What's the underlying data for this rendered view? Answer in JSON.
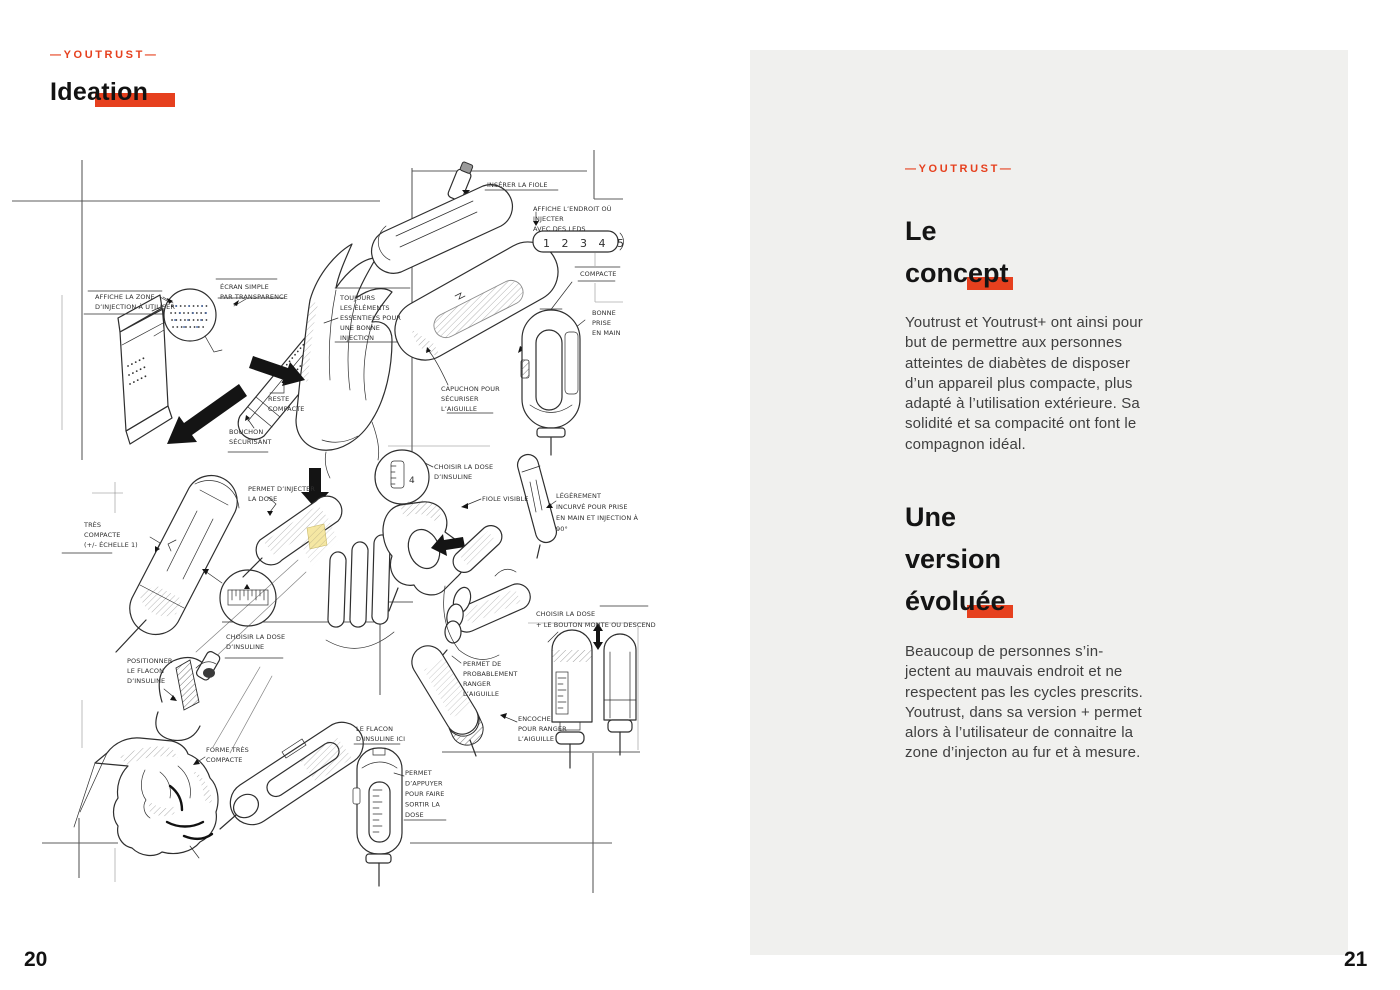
{
  "colors": {
    "accent": "#e6401e",
    "panel": "#f0f0ee",
    "sketch_blue": "#3b5fa0",
    "sketch_yellow": "#f5e7a3"
  },
  "left_page": {
    "brand": "—YOUTRUST—",
    "title": "Ideation",
    "page_number": "20",
    "sketch": {
      "led_scale": "1 2 3 4 5",
      "dose_value": "4",
      "annotations": {
        "zone": [
          "AFFICHE LA ZONE",
          "D’INJECTION À UTILISER"
        ],
        "ecran": [
          "ÉCRAN SIMPLE",
          "PAR TRANSPARENCE"
        ],
        "toujours": [
          "TOUJOURS",
          "LES ÉLÉMENTS",
          "ESSENTIELS POUR",
          "UNE BONNE",
          "INJECTION"
        ],
        "reste": [
          "RESTE",
          "COMPACTE"
        ],
        "bouchon": [
          "BOUCHON",
          "SÉCURISANT"
        ],
        "inserer": [
          "INSÉRER LA FIOLE"
        ],
        "endroit": [
          "AFFICHE L’ENDROIT OÙ",
          "INJECTER",
          "AVEC DES LEDS"
        ],
        "compacte": [
          "COMPACTE"
        ],
        "prise": [
          "BONNE",
          "PRISE",
          "EN MAIN"
        ],
        "capuchon": [
          "CAPUCHON POUR",
          "SÉCURISER",
          "L’AIGUILLE"
        ],
        "tres_compacte": [
          "TRÈS",
          "COMPACTE",
          "(+/- ÉCHELLE 1)"
        ],
        "injecter_dose": [
          "PERMET D’INJECTER",
          "LA DOSE"
        ],
        "choisir1": [
          "CHOISIR LA DOSE",
          "D’INSULINE"
        ],
        "positionner": [
          "POSITIONNER",
          "LE FLACON",
          "D’INSULINE"
        ],
        "choisir2": [
          "CHOISIR LA DOSE",
          "D’INSULINE"
        ],
        "fiole_visible": [
          "FIOLE VISIBLE"
        ],
        "incurve": [
          "LÉGÈREMENT",
          "INCURVÉ POUR PRISE",
          "EN MAIN ET INJECTION À",
          "90°"
        ],
        "choisir3": [
          "CHOISIR LA DOSE",
          "+ LE BOUTON  MONTE OU DESCEND"
        ],
        "ranger": [
          "PERMET DE",
          "PROBABLEMENT",
          "RANGER",
          "L’AIGUILLE"
        ],
        "encoche": [
          "ENCOCHE",
          "POUR RANGER",
          "L’AIGUILLE"
        ],
        "forme": [
          "FORME TRÈS",
          "COMPACTE"
        ],
        "flacon_ici": [
          "LE FLACON",
          "D’INSULINE ICI"
        ],
        "appuyer": [
          "PERMET",
          "D’APPUYER",
          "POUR FAIRE",
          "SORTIR LA",
          "DOSE"
        ]
      }
    }
  },
  "right_page": {
    "brand": "—YOUTRUST—",
    "heading_concept": {
      "line1": "Le",
      "line2": "concept"
    },
    "para_concept": "Youtrust et Youtrust+ ont ainsi pour\nbut de permettre aux personnes\natteintes de diabètes de disposer\nd’un appareil plus compacte, plus\nadapté à l’utilisation extérieure. Sa\nsolidité et sa compacité ont font le\ncompagnon idéal.",
    "heading_version": {
      "line1": "Une",
      "line2": "version",
      "line3": "évoluée"
    },
    "para_version": "Beaucoup de personnes s’in-\njectent au mauvais endroit et ne\nrespectent pas les cycles prescrits.\nYoutrust, dans sa version + permet\nalors à l’utilisateur de connaitre la\nzone d’injecton au fur et à mesure.",
    "page_number": "21"
  }
}
